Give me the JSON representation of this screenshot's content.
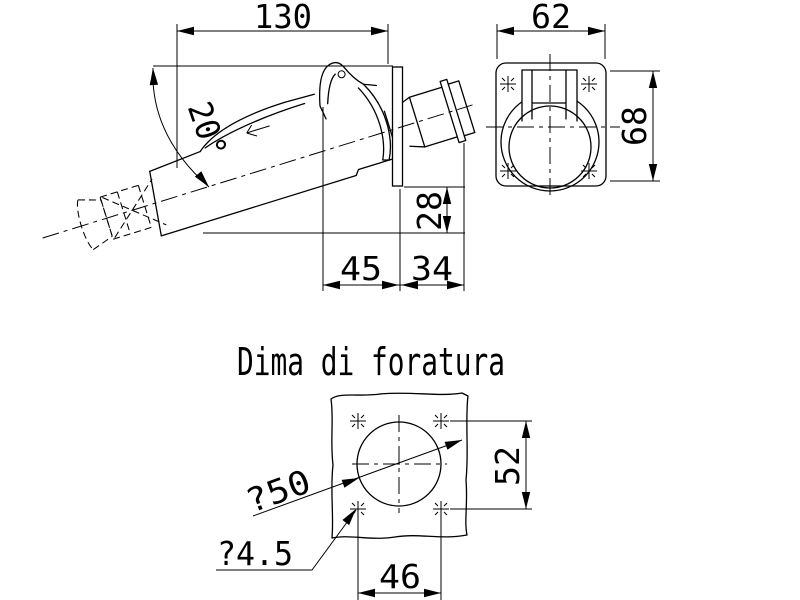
{
  "title": "Dima di foratura",
  "side_view": {
    "overall_width": "130",
    "angle": "20°",
    "height_below_flange": "28",
    "latch_to_flange": "45",
    "flange_to_outlet": "34"
  },
  "front_view": {
    "width": "62",
    "height": "68"
  },
  "template": {
    "circle_diameter": "?50",
    "hole_diameter": "?4.5",
    "hole_spacing_vertical": "52",
    "hole_spacing_horizontal": "46"
  },
  "colors": {
    "line": "#000000",
    "background": "#ffffff"
  }
}
